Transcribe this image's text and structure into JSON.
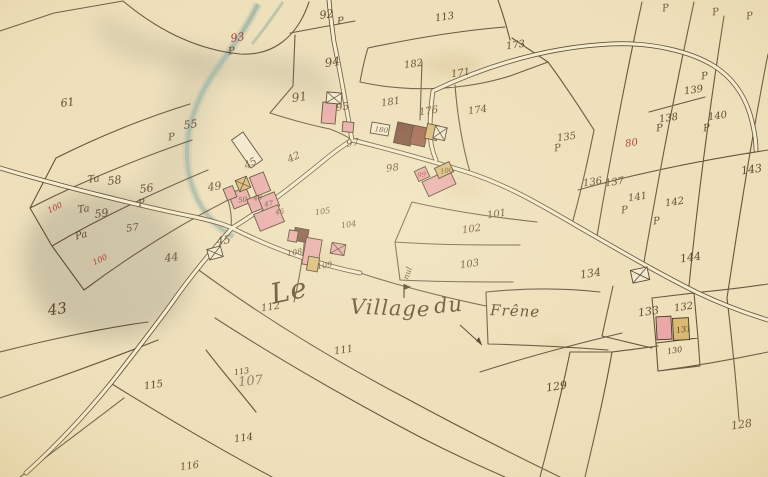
{
  "map": {
    "place_name": "Le Village du Frêne",
    "colors": {
      "paper": "#f0e2bd",
      "paper_light": "#f5ecce",
      "line": "#4b3a26",
      "ink": "#5e452b",
      "red": "#ab3a2c",
      "pencil": "#8b7f6d",
      "stream": "#a4b9ab",
      "hill": "#8c8677",
      "pink": "#e8a7a8",
      "pink_stroke": "#97343c",
      "dark": "#7c4a37",
      "dark2": "#9a5a46",
      "tan": "#d8b873",
      "box": "#f3ead0",
      "none": "#f3ead0"
    },
    "title": {
      "words": [
        {
          "t": "Le",
          "x": 291,
          "y": 300,
          "s": 28,
          "r": -12,
          "cls": "title"
        },
        {
          "t": "Village",
          "x": 390,
          "y": 315,
          "s": 21,
          "r": 2,
          "cls": "title"
        },
        {
          "t": "du",
          "x": 449,
          "y": 312,
          "s": 21,
          "r": -5,
          "cls": "title"
        },
        {
          "t": "Frêne",
          "x": 515,
          "y": 316,
          "s": 15,
          "r": 2,
          "cls": "title"
        }
      ]
    },
    "labels": [
      {
        "t": "61",
        "x": 68,
        "y": 106,
        "s": 11
      },
      {
        "t": "93",
        "x": 238,
        "y": 41,
        "c": "red",
        "s": 11
      },
      {
        "t": "P",
        "x": 232,
        "y": 54
      },
      {
        "t": "55",
        "x": 191,
        "y": 128,
        "s": 11
      },
      {
        "t": "P",
        "x": 172,
        "y": 140
      },
      {
        "t": "92",
        "x": 327,
        "y": 18,
        "s": 11
      },
      {
        "t": "P",
        "x": 341,
        "y": 24
      },
      {
        "t": "113",
        "x": 445,
        "y": 20
      },
      {
        "t": "173",
        "x": 516,
        "y": 48
      },
      {
        "t": "94",
        "x": 333,
        "y": 66,
        "s": 12
      },
      {
        "t": "182",
        "x": 414,
        "y": 67
      },
      {
        "t": "171",
        "x": 461,
        "y": 76
      },
      {
        "t": "91",
        "x": 300,
        "y": 101,
        "s": 12
      },
      {
        "t": "95",
        "x": 343,
        "y": 110
      },
      {
        "t": "181",
        "x": 391,
        "y": 105
      },
      {
        "t": "176",
        "x": 429,
        "y": 114
      },
      {
        "t": "174",
        "x": 478,
        "y": 113
      },
      {
        "t": "135",
        "x": 567,
        "y": 140
      },
      {
        "t": "P",
        "x": 558,
        "y": 151
      },
      {
        "t": "139",
        "x": 694,
        "y": 93
      },
      {
        "t": "P",
        "x": 705,
        "y": 79
      },
      {
        "t": "138",
        "x": 669,
        "y": 121
      },
      {
        "t": "P",
        "x": 660,
        "y": 131
      },
      {
        "t": "140",
        "x": 718,
        "y": 119
      },
      {
        "t": "P",
        "x": 707,
        "y": 131
      },
      {
        "t": "143",
        "x": 752,
        "y": 173,
        "s": 11
      },
      {
        "t": "80",
        "x": 632,
        "y": 146,
        "c": "red"
      },
      {
        "t": "P",
        "x": 666,
        "y": 11
      },
      {
        "t": "P",
        "x": 716,
        "y": 15
      },
      {
        "t": "P",
        "x": 750,
        "y": 19
      },
      {
        "t": "180",
        "x": 381,
        "y": 132,
        "s": 7,
        "r": 8
      },
      {
        "t": "97",
        "x": 353,
        "y": 146
      },
      {
        "t": "98",
        "x": 393,
        "y": 171
      },
      {
        "t": "99",
        "x": 422,
        "y": 177,
        "c": "red",
        "s": 7
      },
      {
        "t": "100",
        "x": 447,
        "y": 173,
        "s": 7
      },
      {
        "t": "Ta",
        "x": 94,
        "y": 182
      },
      {
        "t": "58",
        "x": 115,
        "y": 184,
        "s": 11
      },
      {
        "t": "56",
        "x": 147,
        "y": 192,
        "s": 11
      },
      {
        "t": "P",
        "x": 142,
        "y": 206
      },
      {
        "t": "Ta",
        "x": 84,
        "y": 212
      },
      {
        "t": "59",
        "x": 102,
        "y": 217,
        "s": 11
      },
      {
        "t": "100",
        "x": 56,
        "y": 210,
        "c": "red",
        "s": 8,
        "r": -25
      },
      {
        "t": "Pa",
        "x": 82,
        "y": 238,
        "r": -15
      },
      {
        "t": "100",
        "x": 101,
        "y": 262,
        "c": "red",
        "s": 8,
        "r": -25
      },
      {
        "t": "57",
        "x": 133,
        "y": 231
      },
      {
        "t": "49",
        "x": 215,
        "y": 190,
        "s": 11
      },
      {
        "t": "43",
        "x": 58,
        "y": 314,
        "s": 15
      },
      {
        "t": "44",
        "x": 172,
        "y": 261,
        "s": 11
      },
      {
        "t": "45",
        "x": 224,
        "y": 244,
        "s": 11
      },
      {
        "t": "45",
        "x": 252,
        "y": 166,
        "r": -30
      },
      {
        "t": "42",
        "x": 295,
        "y": 160,
        "r": -25
      },
      {
        "t": "50",
        "x": 243,
        "y": 202,
        "s": 7
      },
      {
        "t": "48",
        "x": 258,
        "y": 200,
        "s": 7
      },
      {
        "t": "47",
        "x": 269,
        "y": 206,
        "s": 7
      },
      {
        "t": "46",
        "x": 280,
        "y": 214,
        "s": 7
      },
      {
        "t": "105",
        "x": 323,
        "y": 214,
        "s": 8
      },
      {
        "t": "104",
        "x": 349,
        "y": 227,
        "s": 8
      },
      {
        "t": "108",
        "x": 295,
        "y": 255,
        "s": 8
      },
      {
        "t": "109",
        "x": 325,
        "y": 268,
        "s": 8
      },
      {
        "t": "101",
        "x": 497,
        "y": 217
      },
      {
        "t": "102",
        "x": 472,
        "y": 232
      },
      {
        "t": "103",
        "x": 470,
        "y": 267
      },
      {
        "t": "nul",
        "x": 410,
        "y": 274,
        "s": 8,
        "r": -72
      },
      {
        "t": "112",
        "x": 271,
        "y": 310
      },
      {
        "t": "111",
        "x": 344,
        "y": 353
      },
      {
        "t": "113",
        "x": 242,
        "y": 374,
        "s": 8
      },
      {
        "t": "107",
        "x": 251,
        "y": 385,
        "s": 13,
        "c": "pencil",
        "r": -6
      },
      {
        "t": "114",
        "x": 244,
        "y": 441
      },
      {
        "t": "115",
        "x": 154,
        "y": 388
      },
      {
        "t": "116",
        "x": 190,
        "y": 469
      },
      {
        "t": "134",
        "x": 591,
        "y": 277,
        "s": 11
      },
      {
        "t": "144",
        "x": 691,
        "y": 261,
        "s": 11
      },
      {
        "t": "141",
        "x": 638,
        "y": 200
      },
      {
        "t": "142",
        "x": 675,
        "y": 205
      },
      {
        "t": "136",
        "x": 593,
        "y": 185
      },
      {
        "t": "137",
        "x": 615,
        "y": 185
      },
      {
        "t": "P",
        "x": 625,
        "y": 213
      },
      {
        "t": "P",
        "x": 657,
        "y": 224
      },
      {
        "t": "133",
        "x": 649,
        "y": 315,
        "s": 11
      },
      {
        "t": "132",
        "x": 684,
        "y": 310
      },
      {
        "t": "131",
        "x": 684,
        "y": 332,
        "s": 8
      },
      {
        "t": "130",
        "x": 675,
        "y": 353,
        "s": 8
      },
      {
        "t": "129",
        "x": 557,
        "y": 390,
        "s": 11
      },
      {
        "t": "128",
        "x": 742,
        "y": 428,
        "s": 11
      }
    ],
    "buildings": [
      {
        "cx": 260,
        "cy": 184,
        "w": 15,
        "h": 20,
        "r": -22,
        "f": "pink"
      },
      {
        "cx": 240,
        "cy": 198,
        "w": 19,
        "h": 16,
        "r": -22,
        "f": "pink"
      },
      {
        "cx": 255,
        "cy": 204,
        "w": 12,
        "h": 14,
        "r": -22,
        "f": "pink"
      },
      {
        "cx": 269,
        "cy": 202,
        "w": 17,
        "h": 15,
        "r": -22,
        "f": "pink"
      },
      {
        "cx": 269,
        "cy": 218,
        "w": 26,
        "h": 18,
        "r": -22,
        "f": "pink"
      },
      {
        "cx": 243,
        "cy": 184,
        "w": 12,
        "h": 12,
        "r": -22,
        "f": "tan",
        "hatch": true
      },
      {
        "cx": 230,
        "cy": 193,
        "w": 10,
        "h": 12,
        "r": -22,
        "f": "pink"
      },
      {
        "cx": 247,
        "cy": 150,
        "w": 14,
        "h": 34,
        "r": -35,
        "f": "none"
      },
      {
        "cx": 329,
        "cy": 113,
        "w": 14,
        "h": 21,
        "r": 5,
        "f": "pink"
      },
      {
        "cx": 348,
        "cy": 127,
        "w": 11,
        "h": 10,
        "r": 5,
        "f": "pink"
      },
      {
        "cx": 334,
        "cy": 98,
        "w": 15,
        "h": 11,
        "r": 5,
        "f": "none",
        "hatch": true
      },
      {
        "cx": 404,
        "cy": 134,
        "w": 17,
        "h": 21,
        "r": 12,
        "f": "dark"
      },
      {
        "cx": 419,
        "cy": 136,
        "w": 15,
        "h": 19,
        "r": 12,
        "f": "dark2"
      },
      {
        "cx": 432,
        "cy": 132,
        "w": 12,
        "h": 15,
        "r": 12,
        "f": "tan"
      },
      {
        "cx": 440,
        "cy": 133,
        "w": 12,
        "h": 13,
        "r": 12,
        "f": "none",
        "hatch": true
      },
      {
        "cx": 380,
        "cy": 129,
        "w": 18,
        "h": 11,
        "r": 10,
        "f": "none"
      },
      {
        "cx": 422,
        "cy": 174,
        "w": 12,
        "h": 11,
        "r": -25,
        "f": "pink"
      },
      {
        "cx": 439,
        "cy": 183,
        "w": 30,
        "h": 16,
        "r": -25,
        "f": "pink"
      },
      {
        "cx": 444,
        "cy": 170,
        "w": 16,
        "h": 11,
        "r": -25,
        "f": "tan"
      },
      {
        "cx": 301,
        "cy": 235,
        "w": 14,
        "h": 13,
        "r": 10,
        "f": "dark"
      },
      {
        "cx": 312,
        "cy": 252,
        "w": 16,
        "h": 27,
        "r": 10,
        "f": "pink"
      },
      {
        "cx": 338,
        "cy": 249,
        "w": 14,
        "h": 11,
        "r": 10,
        "f": "pink",
        "hatch": true
      },
      {
        "cx": 293,
        "cy": 236,
        "w": 9,
        "h": 11,
        "r": 10,
        "f": "pink"
      },
      {
        "cx": 313,
        "cy": 264,
        "w": 11,
        "h": 14,
        "r": 10,
        "f": "tan"
      },
      {
        "cx": 664,
        "cy": 328,
        "w": 15,
        "h": 23,
        "r": -3,
        "f": "pink"
      },
      {
        "cx": 681,
        "cy": 329,
        "w": 16,
        "h": 22,
        "r": -3,
        "f": "tan"
      },
      {
        "cx": 215,
        "cy": 253,
        "w": 14,
        "h": 11,
        "r": -15,
        "f": "none",
        "hatch": true
      },
      {
        "cx": 640,
        "cy": 275,
        "w": 17,
        "h": 13,
        "r": -12,
        "f": "none",
        "hatch": true
      }
    ]
  }
}
